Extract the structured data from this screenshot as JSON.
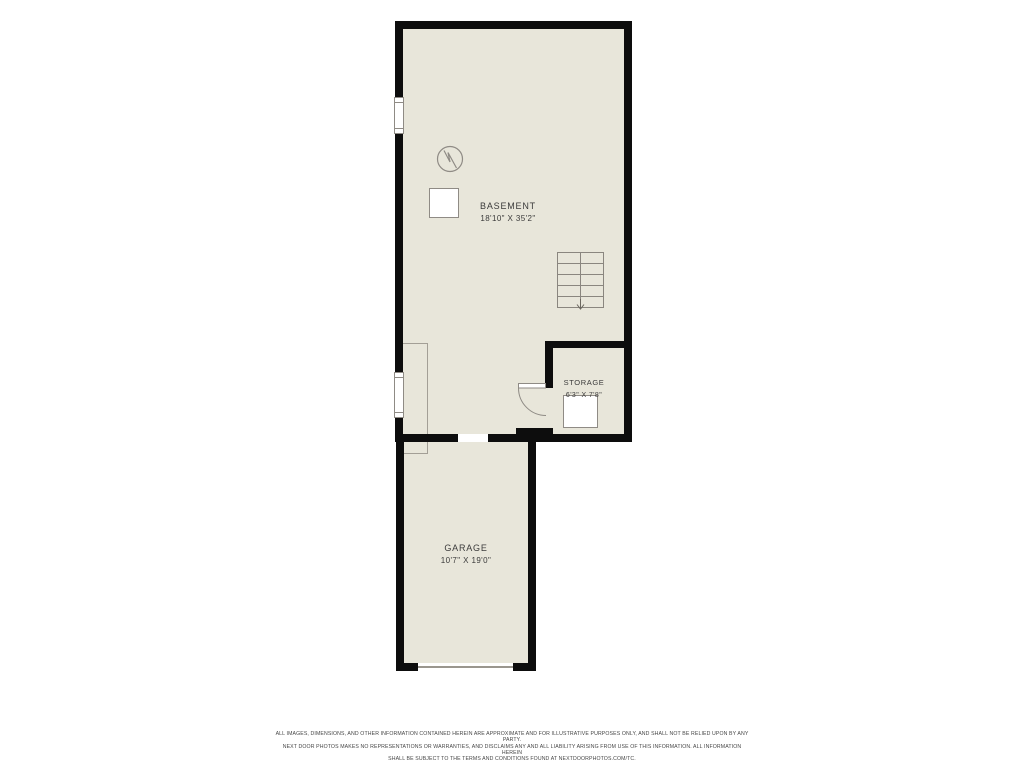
{
  "colors": {
    "background": "#ffffff",
    "floor_fill": "#e8e6da",
    "wall": "#0d0d0d",
    "symbol_line": "#8f8b85",
    "label_text": "#3b3b3b",
    "disclaimer_text": "#474747"
  },
  "rooms": {
    "basement": {
      "name": "BASEMENT",
      "dimensions": "18'10\" X 35'2\""
    },
    "storage": {
      "name": "STORAGE",
      "dimensions": "6'3\" X 7'8\""
    },
    "garage": {
      "name": "GARAGE",
      "dimensions": "10'7\" X 19'0\""
    }
  },
  "symbols": {
    "stairs": "stairs-down-arrow",
    "water_heater": "circle-with-zigzag",
    "furnace": "square-appliance",
    "storage_appliance": "square-appliance",
    "window_count": 2,
    "doors": [
      "storage-swing-door",
      "basement-garage-opening",
      "garage-overhead-door"
    ]
  },
  "disclaimer": {
    "line_1": "ALL IMAGES, DIMENSIONS, AND OTHER INFORMATION CONTAINED HEREIN ARE APPROXIMATE AND FOR ILLUSTRATIVE PURPOSES ONLY, AND SHALL NOT BE RELIED UPON BY ANY PARTY.",
    "line_2": "NEXT DOOR PHOTOS MAKES NO REPRESENTATIONS OR WARRANTIES, AND DISCLAIMS ANY AND ALL LIABILITY ARISING FROM USE OF THIS INFORMATION. ALL INFORMATION HEREIN",
    "line_3": "SHALL BE SUBJECT TO THE TERMS AND CONDITIONS FOUND AT NEXTDOORPHOTOS.COM/TC."
  }
}
